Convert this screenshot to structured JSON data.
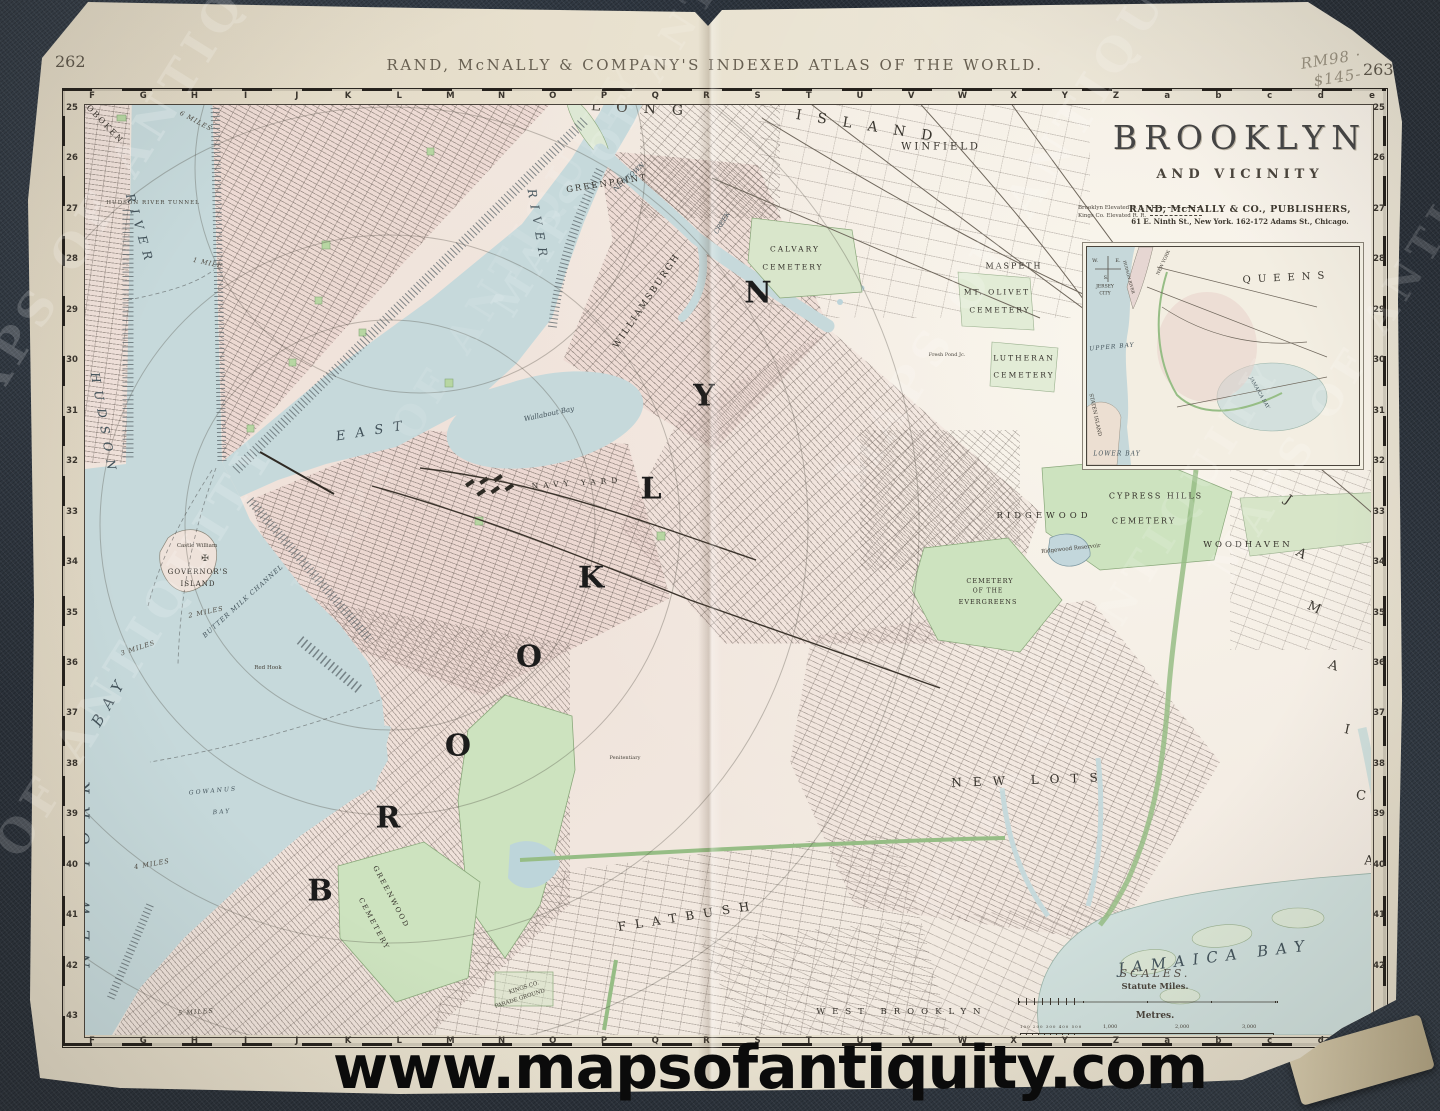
{
  "photo": {
    "pencil_note_line1": "RM98 ·",
    "pencil_note_line2": "$145-",
    "watermark_url": "www.mapsofantiquity.com",
    "ghost_watermark": "MAPS OF ANTIQUITY"
  },
  "atlas": {
    "header": "RAND, McNALLY & COMPANY'S INDEXED ATLAS OF THE WORLD.",
    "page_number_left": "262",
    "page_number_right": "263"
  },
  "title_block": {
    "title": "BROOKLYN",
    "subtitle": "AND VICINITY",
    "legend": [
      {
        "label": "Brooklyn Elevated R. R."
      },
      {
        "label": "Kings Co. Elevated R. R."
      }
    ],
    "publisher_line1": "RAND, McNALLY & CO., PUBLISHERS,",
    "publisher_line2": "61 E. Ninth St., New York.   162-172 Adams St., Chicago."
  },
  "grid": {
    "letters": [
      "F",
      "G",
      "H",
      "I",
      "J",
      "K",
      "L",
      "M",
      "N",
      "O",
      "P",
      "Q",
      "R",
      "S",
      "T",
      "U",
      "V",
      "W",
      "X",
      "Y",
      "Z",
      "a",
      "b",
      "c",
      "d",
      "e"
    ],
    "numbers": [
      "25",
      "26",
      "27",
      "28",
      "29",
      "30",
      "31",
      "32",
      "33",
      "34",
      "35",
      "36",
      "37",
      "38",
      "39",
      "40",
      "41",
      "42",
      "43"
    ]
  },
  "scales": {
    "heading": "SCALES.",
    "miles_label": "Statute Miles.",
    "metres_label": "Metres.",
    "metres_small": "100 200 300 400 500",
    "metres_ticks": [
      "1,000",
      "2,000",
      "3,000"
    ],
    "copyright_line1": "Rand, McNally & Co.'s New Family Map of Brooklyn and Vicinity.",
    "copyright_line2": "Copyright, 1895, by Rand, McNally & Co."
  },
  "inset_labels": [
    {
      "t": "QUEENS",
      "x": 200,
      "y": 31,
      "r": -3,
      "s": 10,
      "ls": 7,
      "c": "inset"
    },
    {
      "t": "JERSEY",
      "x": 18,
      "y": 40,
      "r": 0,
      "s": 4.5,
      "ls": 0,
      "c": "inset"
    },
    {
      "t": "CITY",
      "x": 18,
      "y": 47,
      "r": 0,
      "s": 4.5,
      "ls": 0,
      "c": "inset"
    },
    {
      "t": "NEW YORK",
      "x": 77,
      "y": 16,
      "r": -65,
      "s": 4.5,
      "ls": 0,
      "c": "inset"
    },
    {
      "t": "HUDSON RIVER",
      "x": 42,
      "y": 30,
      "r": 75,
      "s": 4,
      "ls": 0,
      "c": "inset"
    },
    {
      "t": "UPPER BAY",
      "x": 25,
      "y": 100,
      "r": -5,
      "s": 6,
      "ls": 1,
      "c": "water"
    },
    {
      "t": "LOWER BAY",
      "x": 30,
      "y": 207,
      "r": 0,
      "s": 6,
      "ls": 1,
      "c": "water"
    },
    {
      "t": "STATEN ISLAND",
      "x": 8,
      "y": 168,
      "r": 78,
      "s": 5,
      "ls": 0,
      "c": "inset"
    },
    {
      "t": "JAMAICA BAY",
      "x": 172,
      "y": 146,
      "r": 60,
      "s": 5,
      "ls": 0,
      "c": "water"
    },
    {
      "t": "W.",
      "x": 8,
      "y": 14,
      "r": 0,
      "s": 5,
      "ls": 0,
      "c": "inset"
    },
    {
      "t": "E.",
      "x": 31,
      "y": 14,
      "r": 0,
      "s": 5,
      "ls": 0,
      "c": "inset"
    },
    {
      "t": "S.",
      "x": 19,
      "y": 31,
      "r": 0,
      "s": 5,
      "ls": 0,
      "c": "inset"
    }
  ],
  "map_labels": [
    {
      "t": "B",
      "x": 320,
      "y": 891,
      "r": 0,
      "s": 30,
      "ls": 0,
      "c": "giant"
    },
    {
      "t": "R",
      "x": 388,
      "y": 818,
      "r": 0,
      "s": 30,
      "ls": 0,
      "c": "giant"
    },
    {
      "t": "O",
      "x": 458,
      "y": 746,
      "r": 0,
      "s": 30,
      "ls": 0,
      "c": "giant"
    },
    {
      "t": "O",
      "x": 529,
      "y": 657,
      "r": 0,
      "s": 30,
      "ls": 0,
      "c": "giant"
    },
    {
      "t": "K",
      "x": 591,
      "y": 578,
      "r": 0,
      "s": 30,
      "ls": 0,
      "c": "giant"
    },
    {
      "t": "L",
      "x": 651,
      "y": 489,
      "r": 0,
      "s": 30,
      "ls": 0,
      "c": "giant"
    },
    {
      "t": "Y",
      "x": 704,
      "y": 396,
      "r": 0,
      "s": 30,
      "ls": 0,
      "c": "giant"
    },
    {
      "t": "N",
      "x": 758,
      "y": 293,
      "r": 0,
      "s": 30,
      "ls": 0,
      "c": "giant"
    },
    {
      "t": "LONG",
      "x": 645,
      "y": 109,
      "r": 3,
      "s": 14,
      "ls": 16,
      "c": "region"
    },
    {
      "t": "ISLAND",
      "x": 872,
      "y": 127,
      "r": 9,
      "s": 14,
      "ls": 16,
      "c": "region"
    },
    {
      "t": "J",
      "x": 1288,
      "y": 500,
      "r": 35,
      "s": 13,
      "ls": 0,
      "c": "region"
    },
    {
      "t": "A",
      "x": 1301,
      "y": 554,
      "r": 30,
      "s": 13,
      "ls": 0,
      "c": "region"
    },
    {
      "t": "M",
      "x": 1314,
      "y": 608,
      "r": 24,
      "s": 13,
      "ls": 0,
      "c": "region"
    },
    {
      "t": "A",
      "x": 1333,
      "y": 666,
      "r": 18,
      "s": 13,
      "ls": 0,
      "c": "region"
    },
    {
      "t": "I",
      "x": 1347,
      "y": 730,
      "r": 12,
      "s": 13,
      "ls": 0,
      "c": "region"
    },
    {
      "t": "C",
      "x": 1361,
      "y": 796,
      "r": 6,
      "s": 13,
      "ls": 0,
      "c": "region"
    },
    {
      "t": "A",
      "x": 1369,
      "y": 861,
      "r": 2,
      "s": 13,
      "ls": 0,
      "c": "region"
    },
    {
      "t": "NEW YORK",
      "x": 84,
      "y": 868,
      "r": -90,
      "s": 16,
      "ls": 13,
      "c": "water"
    },
    {
      "t": "BAY",
      "x": 110,
      "y": 700,
      "r": -60,
      "s": 15,
      "ls": 9,
      "c": "water"
    },
    {
      "t": "HUDSON",
      "x": 104,
      "y": 425,
      "r": 80,
      "s": 12,
      "ls": 8,
      "c": "water"
    },
    {
      "t": "RIVER",
      "x": 140,
      "y": 230,
      "r": 74,
      "s": 12,
      "ls": 7,
      "c": "water"
    },
    {
      "t": "EAST",
      "x": 374,
      "y": 431,
      "r": -9,
      "s": 13,
      "ls": 10,
      "c": "water"
    },
    {
      "t": "RIVER",
      "x": 538,
      "y": 226,
      "r": 80,
      "s": 12,
      "ls": 7,
      "c": "water"
    },
    {
      "t": "JAMAICA BAY",
      "x": 1215,
      "y": 957,
      "r": -7,
      "s": 15,
      "ls": 8,
      "c": "water"
    },
    {
      "t": "Wallabout Bay",
      "x": 549,
      "y": 414,
      "r": -12,
      "s": 7,
      "ls": 0,
      "c": "water"
    },
    {
      "t": "GOWANUS",
      "x": 213,
      "y": 791,
      "r": -5,
      "s": 6,
      "ls": 2,
      "c": "water"
    },
    {
      "t": "BAY",
      "x": 222,
      "y": 812,
      "r": -5,
      "s": 6,
      "ls": 2,
      "c": "water"
    },
    {
      "t": "BUTTER MILK CHANNEL",
      "x": 243,
      "y": 601,
      "r": -42,
      "s": 6.5,
      "ls": 1,
      "c": "water"
    },
    {
      "t": "NEWTOWN",
      "x": 629,
      "y": 177,
      "r": -42,
      "s": 6.5,
      "ls": 0,
      "c": "water"
    },
    {
      "t": "CREEK",
      "x": 722,
      "y": 223,
      "r": -58,
      "s": 6.5,
      "ls": 0,
      "c": "water"
    },
    {
      "t": "HOBOKEN",
      "x": 102,
      "y": 121,
      "r": 46,
      "s": 8,
      "ls": 2,
      "c": "place"
    },
    {
      "t": "JERSEY CITY",
      "x": 77,
      "y": 330,
      "r": 88,
      "s": 9.5,
      "ls": 5,
      "c": "place"
    },
    {
      "t": "GREENPOINT",
      "x": 607,
      "y": 184,
      "r": -9,
      "s": 8.5,
      "ls": 2,
      "c": "place"
    },
    {
      "t": "WILLIAMSBURGH",
      "x": 647,
      "y": 301,
      "r": -56,
      "s": 9,
      "ls": 2,
      "c": "place"
    },
    {
      "t": "NAVY YARD",
      "x": 577,
      "y": 483,
      "r": -4,
      "s": 7.5,
      "ls": 5,
      "c": "place"
    },
    {
      "t": "WINFIELD",
      "x": 941,
      "y": 147,
      "r": 0,
      "s": 10,
      "ls": 3,
      "c": "place"
    },
    {
      "t": "MASPETH",
      "x": 1014,
      "y": 266,
      "r": 0,
      "s": 8,
      "ls": 2,
      "c": "place"
    },
    {
      "t": "MT. OLIVET",
      "x": 997,
      "y": 292,
      "r": 0,
      "s": 7.5,
      "ls": 2,
      "c": "place"
    },
    {
      "t": "CEMETERY",
      "x": 1000,
      "y": 310,
      "r": 0,
      "s": 7.5,
      "ls": 2,
      "c": "place"
    },
    {
      "t": "CALVARY",
      "x": 795,
      "y": 249,
      "r": 0,
      "s": 7.5,
      "ls": 2,
      "c": "place"
    },
    {
      "t": "CEMETERY",
      "x": 793,
      "y": 267,
      "r": 0,
      "s": 7.5,
      "ls": 2,
      "c": "place"
    },
    {
      "t": "LUTHERAN",
      "x": 1024,
      "y": 358,
      "r": 0,
      "s": 7.5,
      "ls": 2,
      "c": "place"
    },
    {
      "t": "CEMETERY",
      "x": 1024,
      "y": 375,
      "r": 0,
      "s": 7.5,
      "ls": 2,
      "c": "place"
    },
    {
      "t": "RIDGEWOOD",
      "x": 1044,
      "y": 516,
      "r": 0,
      "s": 8.5,
      "ls": 4,
      "c": "place"
    },
    {
      "t": "CYPRESS HILLS",
      "x": 1156,
      "y": 496,
      "r": 0,
      "s": 8,
      "ls": 2,
      "c": "place"
    },
    {
      "t": "CEMETERY",
      "x": 1144,
      "y": 521,
      "r": 0,
      "s": 8,
      "ls": 2,
      "c": "place"
    },
    {
      "t": "CEMETERY",
      "x": 990,
      "y": 581,
      "r": 0,
      "s": 6.5,
      "ls": 1,
      "c": "place"
    },
    {
      "t": "OF THE",
      "x": 988,
      "y": 591,
      "r": 0,
      "s": 6,
      "ls": 1,
      "c": "place"
    },
    {
      "t": "EVERGREENS",
      "x": 988,
      "y": 602,
      "r": 0,
      "s": 6.5,
      "ls": 1,
      "c": "place"
    },
    {
      "t": "WOODHAVEN",
      "x": 1248,
      "y": 545,
      "r": 0,
      "s": 8.5,
      "ls": 3,
      "c": "place"
    },
    {
      "t": "GOVERNOR'S",
      "x": 198,
      "y": 572,
      "r": 0,
      "s": 7,
      "ls": 1,
      "c": "place"
    },
    {
      "t": "ISLAND",
      "x": 198,
      "y": 584,
      "r": 0,
      "s": 7,
      "ls": 1,
      "c": "place"
    },
    {
      "t": "GREENWOOD",
      "x": 391,
      "y": 897,
      "r": 62,
      "s": 7,
      "ls": 2,
      "c": "place"
    },
    {
      "t": "CEMETERY",
      "x": 374,
      "y": 924,
      "r": 62,
      "s": 7,
      "ls": 2,
      "c": "place"
    },
    {
      "t": "WEST BROOKLYN",
      "x": 902,
      "y": 1012,
      "r": 0,
      "s": 8.5,
      "ls": 7,
      "c": "place"
    },
    {
      "t": "FLATBUSH",
      "x": 688,
      "y": 916,
      "r": -9,
      "s": 12,
      "ls": 9,
      "c": "place"
    },
    {
      "t": "NEW LOTS",
      "x": 1030,
      "y": 780,
      "r": -2,
      "s": 12,
      "ls": 11,
      "c": "place"
    },
    {
      "t": "Castle William",
      "x": 197,
      "y": 546,
      "r": 0,
      "s": 5.5,
      "ls": 0,
      "c": "tiny"
    },
    {
      "t": "✠",
      "x": 205,
      "y": 559,
      "r": 0,
      "s": 9,
      "ls": 0,
      "c": "tiny"
    },
    {
      "t": "Ridgewood Reservoir",
      "x": 1071,
      "y": 549,
      "r": -6,
      "s": 5.5,
      "ls": 0,
      "c": "tiny"
    },
    {
      "t": "HUDSON RIVER TUNNEL",
      "x": 153,
      "y": 203,
      "r": 0,
      "s": 5.5,
      "ls": 1,
      "c": "tiny"
    },
    {
      "t": "Hunter's Point Ferry",
      "x": 560,
      "y": 101,
      "r": 0,
      "s": 5,
      "ls": 0,
      "c": "tiny"
    },
    {
      "t": "KINGS CO.",
      "x": 524,
      "y": 988,
      "r": -18,
      "s": 5.5,
      "ls": 0,
      "c": "tiny"
    },
    {
      "t": "PARADE GROUND",
      "x": 520,
      "y": 999,
      "r": -18,
      "s": 5.5,
      "ls": 0,
      "c": "tiny"
    },
    {
      "t": "Red Hook",
      "x": 268,
      "y": 668,
      "r": 0,
      "s": 5.5,
      "ls": 0,
      "c": "tiny"
    },
    {
      "t": "Penitentiary",
      "x": 625,
      "y": 758,
      "r": 0,
      "s": 5,
      "ls": 0,
      "c": "tiny"
    },
    {
      "t": "Fresh Pond Jc.",
      "x": 947,
      "y": 355,
      "r": 0,
      "s": 5,
      "ls": 0,
      "c": "tiny"
    },
    {
      "t": "1 MILE",
      "x": 208,
      "y": 263,
      "r": 12,
      "s": 6.5,
      "ls": 1,
      "c": "arc"
    },
    {
      "t": "2 MILES",
      "x": 206,
      "y": 612,
      "r": -12,
      "s": 6.5,
      "ls": 1,
      "c": "arc"
    },
    {
      "t": "3 MILES",
      "x": 138,
      "y": 648,
      "r": -18,
      "s": 6.5,
      "ls": 1,
      "c": "arc"
    },
    {
      "t": "4 MILES",
      "x": 152,
      "y": 864,
      "r": -10,
      "s": 6.5,
      "ls": 1,
      "c": "arc"
    },
    {
      "t": "5 MILES",
      "x": 196,
      "y": 1012,
      "r": -4,
      "s": 6.5,
      "ls": 1,
      "c": "arc"
    },
    {
      "t": "6 MILES",
      "x": 196,
      "y": 121,
      "r": 28,
      "s": 6.5,
      "ls": 1,
      "c": "arc"
    }
  ],
  "ghosts": [
    {
      "x": 135,
      "y": 150,
      "r": -58,
      "s": 46,
      "o": 0.2
    },
    {
      "x": 660,
      "y": 58,
      "r": -58,
      "s": 38,
      "o": 0.14
    },
    {
      "x": 1030,
      "y": 190,
      "r": -58,
      "s": 46,
      "o": 0.18
    },
    {
      "x": 80,
      "y": 735,
      "r": -58,
      "s": 46,
      "o": 0.18
    },
    {
      "x": 468,
      "y": 330,
      "r": -58,
      "s": 40,
      "o": 0.1
    },
    {
      "x": 1100,
      "y": 635,
      "r": -58,
      "s": 42,
      "o": 0.13
    },
    {
      "x": 1385,
      "y": 310,
      "r": -58,
      "s": 40,
      "o": 0.16
    }
  ],
  "colors": {
    "paper": "#e9e2d0",
    "land": "#f2eae1",
    "water": "#c6d9db",
    "park_green": "#cde3bf",
    "ink": "#3a352e",
    "background_fabric": "#2a313a"
  }
}
